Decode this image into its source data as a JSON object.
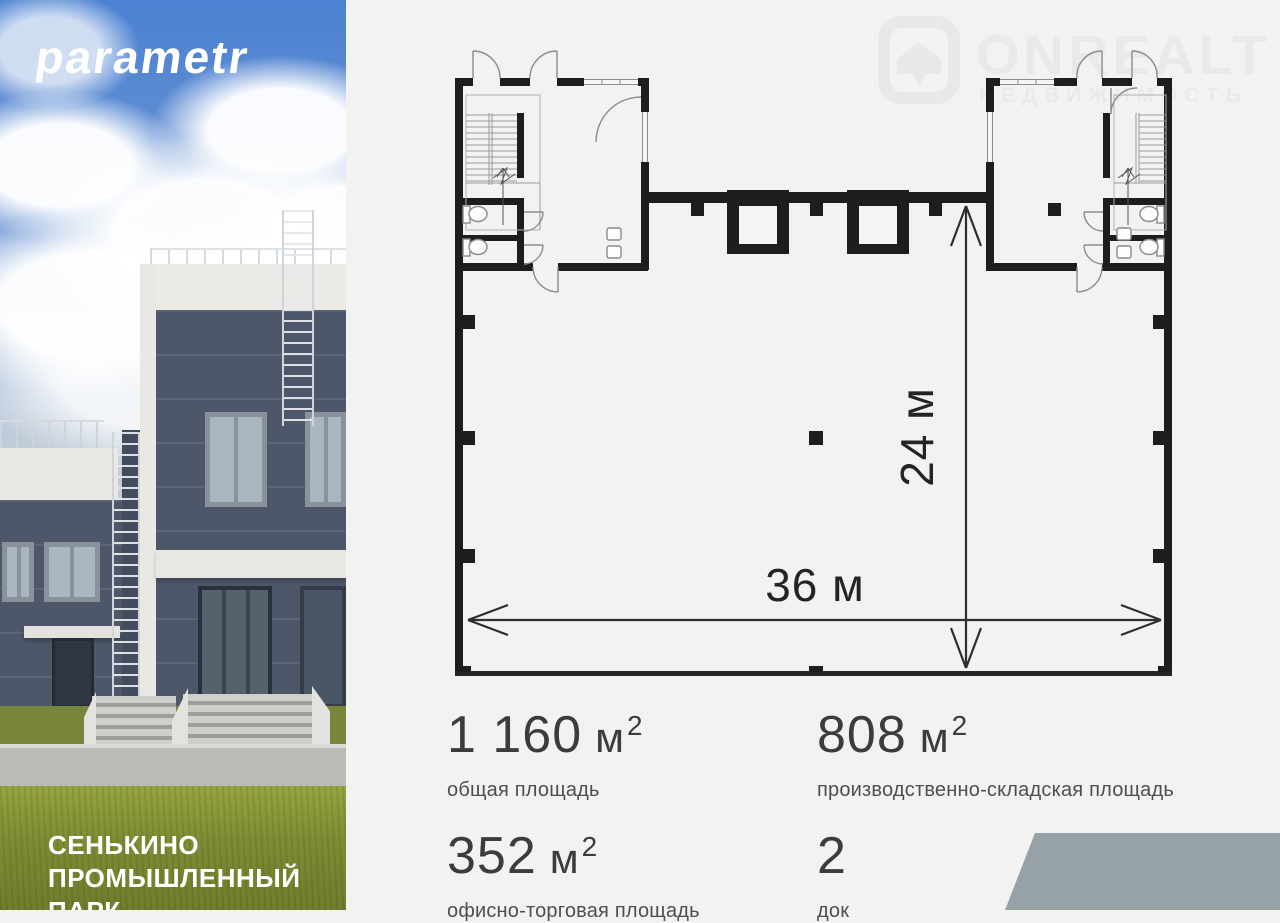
{
  "brand": {
    "logo_text": "parametr",
    "project_lines": [
      "СЕНЬКИНО",
      "ПРОМЫШЛЕННЫЙ",
      "ПАРК"
    ]
  },
  "watermark": {
    "title": "ONREALT",
    "subtitle": "НЕДВИЖИМОСТЬ",
    "icon": "house-icon"
  },
  "floor_plan": {
    "width_label": "36 м",
    "height_label": "24 м"
  },
  "stats": [
    {
      "value": "1 160",
      "unit": "м",
      "sup": "2",
      "label": "общая площадь"
    },
    {
      "value": "808",
      "unit": "м",
      "sup": "2",
      "label": "производственно-складская площадь"
    },
    {
      "value": "352",
      "unit": "м",
      "sup": "2",
      "label": "офисно-торговая площадь"
    },
    {
      "value": "2",
      "unit": "",
      "sup": "",
      "label": "док"
    }
  ],
  "colors": {
    "background": "#f2f2f1",
    "plan_walls": "#1d1d1d",
    "corner_shape": "#97a1a8",
    "sky": "#4b81d1",
    "building": "#4d5769",
    "grass": "#7d8c34",
    "watermark": "#e9e9e7"
  }
}
